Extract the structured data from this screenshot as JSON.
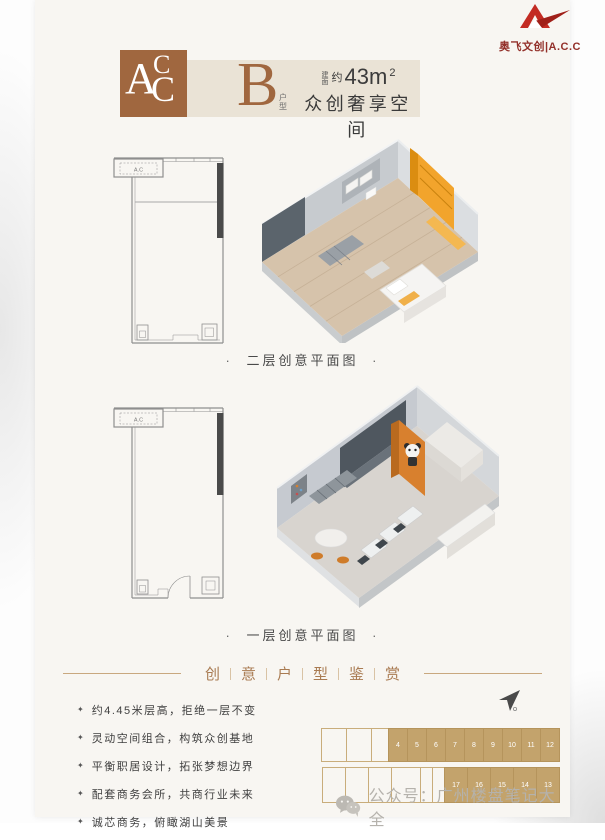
{
  "brand": {
    "logo_text": "奥飞文创|A.C.C"
  },
  "header": {
    "badge_letters": {
      "a": "A",
      "c1": "C",
      "c2": "C"
    },
    "unit_letter": "B",
    "unit_suffix": "户型",
    "area_prefix": "建面",
    "area_approx": "约",
    "area_value": "43m",
    "area_sup": "2",
    "tagline": "众创奢享空间"
  },
  "plans": {
    "caption_dot": "·",
    "second_floor": {
      "caption": "二层创意平面图",
      "ac_label": "A.C"
    },
    "first_floor": {
      "caption": "一层创意平面图",
      "ac_label": "A.C"
    }
  },
  "divider": {
    "chars": [
      "创",
      "意",
      "户",
      "型",
      "鉴",
      "赏"
    ]
  },
  "features": {
    "bullet_icon": "✦",
    "items": [
      "约4.45米层高，拒绝一层不变",
      "灵动空间组合，构筑众创基地",
      "平衡职居设计，拓张梦想边界",
      "配套商务会所，共商行业未来",
      "诚芯商务，俯瞰湖山美景"
    ]
  },
  "unit_grid": {
    "top_units": [
      "4",
      "5",
      "6",
      "7",
      "8",
      "9",
      "10",
      "11",
      "12"
    ],
    "bottom_units": [
      "17",
      "16",
      "15",
      "14",
      "13"
    ]
  },
  "footer": {
    "watermark": "公众号：广州楼盘笔记大全"
  },
  "colors": {
    "brand_red": "#c32b23",
    "accent_brown": "#a0673f",
    "strip_beige": "#eae3d6",
    "divider_brown": "#a97b52",
    "grid_tan": "#c3a36c",
    "render_orange": "#f0a42c"
  }
}
